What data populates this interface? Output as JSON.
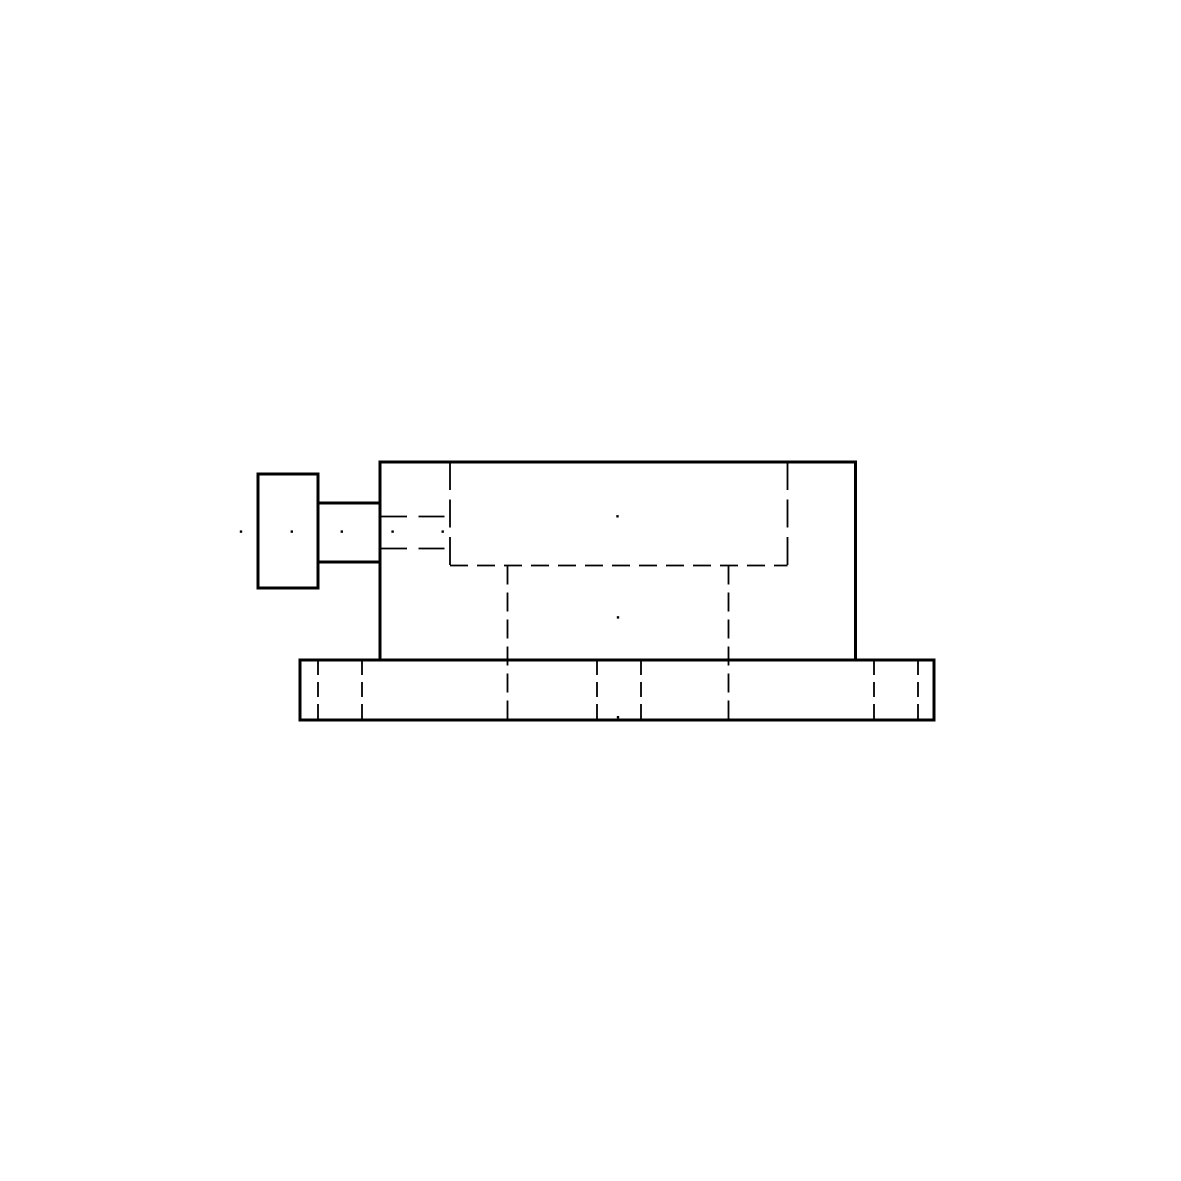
{
  "page": {
    "background_color": "#ffffff",
    "ink_color": "#000000",
    "title": "mechanical-part-side-view-drawing"
  },
  "drawing": {
    "canvas": {
      "width": 1181,
      "height": 1181
    },
    "solid_stroke_width": 3,
    "hidden_stroke_width": 1.8,
    "outlines": [
      {
        "name": "screw-head-outline",
        "x": 258,
        "y": 474,
        "width": 60,
        "height": 114
      },
      {
        "name": "collar-outline",
        "x": 318,
        "y": 503,
        "width": 62,
        "height": 59
      },
      {
        "name": "body-outline",
        "x": 380,
        "y": 462,
        "width": 475.5,
        "height": 198
      },
      {
        "name": "base-plate-outline",
        "x": 300,
        "y": 660,
        "width": 634,
        "height": 60
      }
    ],
    "hidden_lines": [
      {
        "name": "pocket-left-hidden-edge",
        "x1": 450,
        "y1": 462,
        "x2": 450,
        "y2": 565.5,
        "dash": "28 9.5"
      },
      {
        "name": "pocket-right-hidden-edge",
        "x1": 787.5,
        "y1": 462,
        "x2": 787.5,
        "y2": 565.5,
        "dash": "28 9.5"
      },
      {
        "name": "pocket-bottom-hidden-edge",
        "x1": 450,
        "y1": 565.5,
        "x2": 787.5,
        "y2": 565.5,
        "dash": "18 9"
      },
      {
        "name": "bore-upper-hidden-line",
        "x1": 381,
        "y1": 516.5,
        "x2": 450,
        "y2": 516.5,
        "dash": "26 11.5"
      },
      {
        "name": "bore-lower-hidden-line",
        "x1": 381,
        "y1": 548.5,
        "x2": 450,
        "y2": 548.5,
        "dash": "26 11.5"
      },
      {
        "name": "channel-left-hidden-edge",
        "x1": 507.5,
        "y1": 565.5,
        "x2": 507.5,
        "y2": 720,
        "dash": "19 8"
      },
      {
        "name": "channel-right-hidden-edge",
        "x1": 728.5,
        "y1": 565.5,
        "x2": 728.5,
        "y2": 720,
        "dash": "19 8"
      },
      {
        "name": "base-hole-1-left-edge",
        "x1": 318,
        "y1": 660,
        "x2": 318,
        "y2": 720,
        "dash": "15 7"
      },
      {
        "name": "base-hole-1-right-edge",
        "x1": 362,
        "y1": 660,
        "x2": 362,
        "y2": 720,
        "dash": "15 7"
      },
      {
        "name": "base-hole-2-left-edge",
        "x1": 597,
        "y1": 660,
        "x2": 597,
        "y2": 720,
        "dash": "15 7"
      },
      {
        "name": "base-hole-2-right-edge",
        "x1": 641,
        "y1": 660,
        "x2": 641,
        "y2": 720,
        "dash": "15 7"
      },
      {
        "name": "base-hole-3-left-edge",
        "x1": 874,
        "y1": 660,
        "x2": 874,
        "y2": 720,
        "dash": "15 7"
      },
      {
        "name": "base-hole-3-right-edge",
        "x1": 918,
        "y1": 660,
        "x2": 918,
        "y2": 720,
        "dash": "15 7"
      }
    ],
    "center_dots": {
      "size": 2.4,
      "points": [
        {
          "name": "centerline-dot-1",
          "x": 241,
          "y": 531.6
        },
        {
          "name": "centerline-dot-2",
          "x": 291.8,
          "y": 531.6
        },
        {
          "name": "centerline-dot-3",
          "x": 341.8,
          "y": 531.6
        },
        {
          "name": "centerline-dot-4",
          "x": 392.6,
          "y": 531.6
        },
        {
          "name": "centerline-dot-5",
          "x": 442.7,
          "y": 531.6
        },
        {
          "name": "pocket-center-dot",
          "x": 617.5,
          "y": 516.3
        },
        {
          "name": "channel-center-dot",
          "x": 618,
          "y": 617.4
        },
        {
          "name": "base-bottom-center-dot",
          "x": 618,
          "y": 717.2
        }
      ]
    }
  }
}
